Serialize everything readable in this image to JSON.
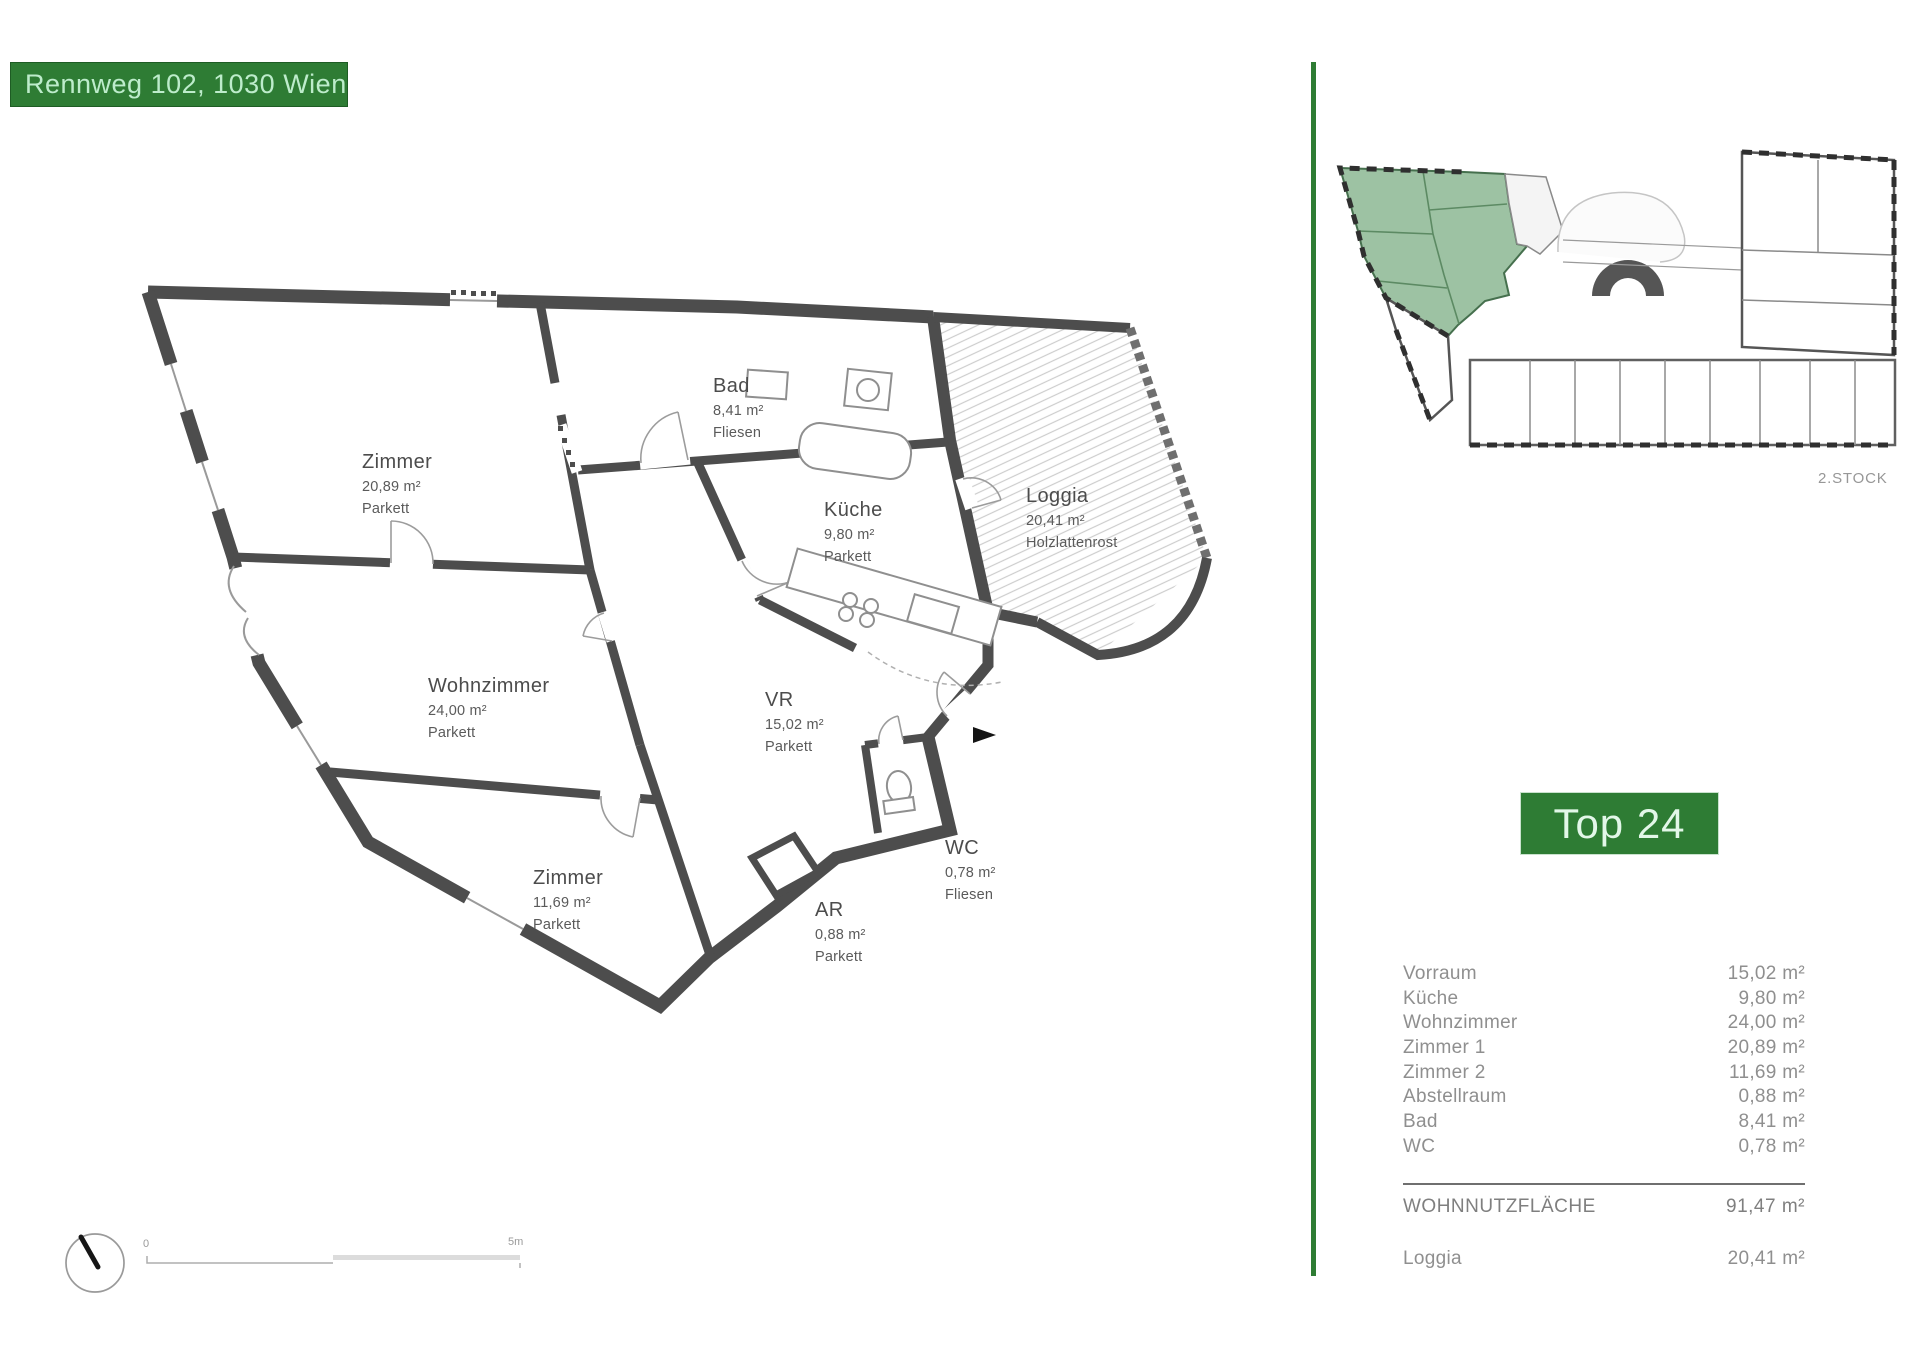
{
  "header": {
    "address": "Rennweg 102, 1030 Wien"
  },
  "unit": {
    "label": "Top 24"
  },
  "overview": {
    "floor_label": "2.STOCK"
  },
  "plan": {
    "rooms": [
      {
        "name": "Zimmer",
        "area": "20,89 m²",
        "floor": "Parkett"
      },
      {
        "name": "Bad",
        "area": "8,41 m²",
        "floor": "Fliesen"
      },
      {
        "name": "Küche",
        "area": "9,80 m²",
        "floor": "Parkett"
      },
      {
        "name": "Loggia",
        "area": "20,41 m²",
        "floor": "Holzlattenrost"
      },
      {
        "name": "Wohnzimmer",
        "area": "24,00 m²",
        "floor": "Parkett"
      },
      {
        "name": "VR",
        "area": "15,02 m²",
        "floor": "Parkett"
      },
      {
        "name": "Zimmer",
        "area": "11,69 m²",
        "floor": "Parkett"
      },
      {
        "name": "WC",
        "area": "0,78 m²",
        "floor": "Fliesen"
      },
      {
        "name": "AR",
        "area": "0,88 m²",
        "floor": "Parkett"
      }
    ]
  },
  "scalebar": {
    "zero": "0",
    "five": "5m"
  },
  "schedule": {
    "rows": [
      {
        "label": "Vorraum",
        "value": "15,02 m²"
      },
      {
        "label": "Küche",
        "value": "9,80 m²"
      },
      {
        "label": "Wohnzimmer",
        "value": "24,00 m²"
      },
      {
        "label": "Zimmer 1",
        "value": "20,89 m²"
      },
      {
        "label": "Zimmer 2",
        "value": "11,69 m²"
      },
      {
        "label": "Abstellraum",
        "value": "0,88 m²"
      },
      {
        "label": "Bad",
        "value": "8,41 m²"
      },
      {
        "label": "WC",
        "value": "0,78 m²"
      }
    ],
    "total": {
      "label": "WOHNNUTZFLÄCHE",
      "value": "91,47 m²"
    },
    "outdoor": {
      "label": "Loggia",
      "value": "20,41 m²"
    }
  },
  "colors": {
    "brand_green": "#2e7c34",
    "header_text": "#bdeccb",
    "wall_gray": "#4d4d4d",
    "highlight_green": "#9dc2a3",
    "table_text": "#8f8f8f"
  }
}
